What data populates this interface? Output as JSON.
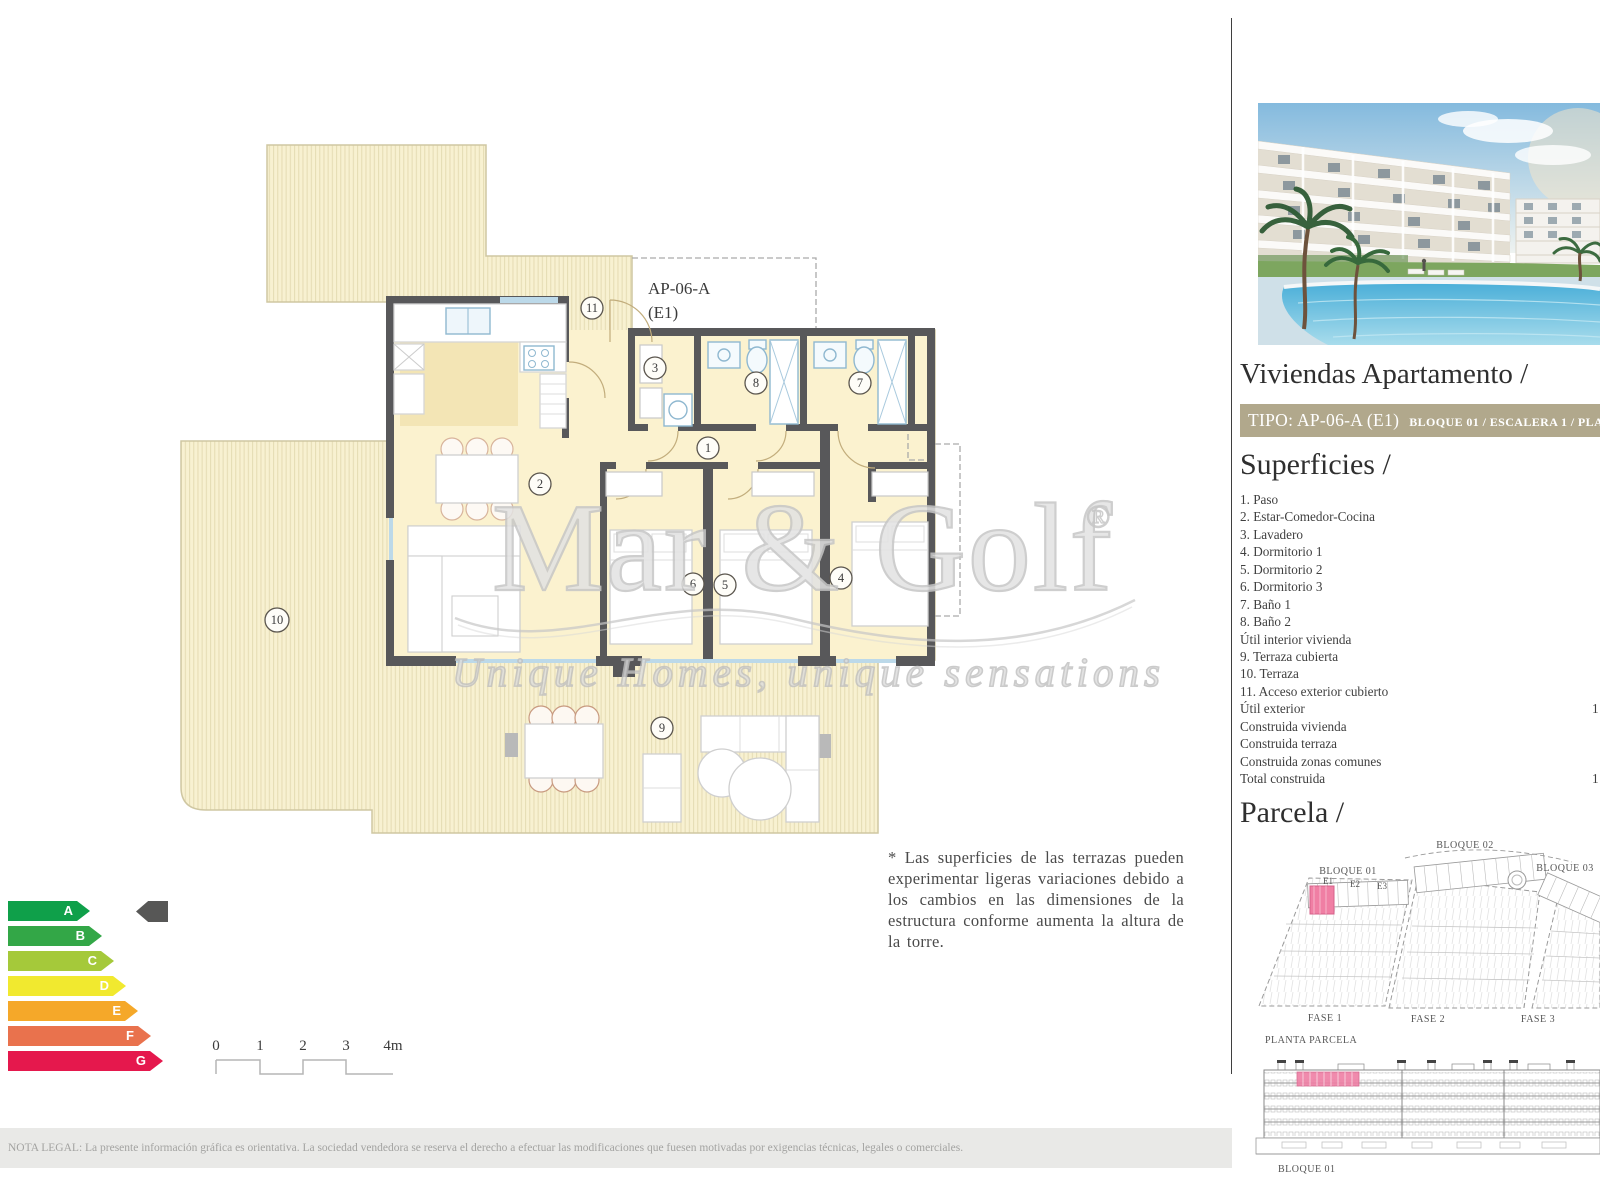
{
  "floorplan": {
    "unit_label": "AP-06-A",
    "unit_sublabel": "(E1)",
    "rooms": [
      {
        "num": "1"
      },
      {
        "num": "2"
      },
      {
        "num": "3"
      },
      {
        "num": "4"
      },
      {
        "num": "5"
      },
      {
        "num": "6"
      },
      {
        "num": "7"
      },
      {
        "num": "8"
      },
      {
        "num": "9"
      },
      {
        "num": "10"
      },
      {
        "num": "11"
      }
    ]
  },
  "watermark": {
    "brand": "Mar & Golf",
    "registered": "®",
    "tagline": "Unique Homes, unique sensations"
  },
  "scalebar": {
    "ticks": [
      "0",
      "1",
      "2",
      "3",
      "4m"
    ]
  },
  "energy": {
    "rows": [
      {
        "letter": "A",
        "color": "#0fa04a"
      },
      {
        "letter": "B",
        "color": "#33a747"
      },
      {
        "letter": "C",
        "color": "#a5c93a"
      },
      {
        "letter": "D",
        "color": "#f1e92f"
      },
      {
        "letter": "E",
        "color": "#f5a829"
      },
      {
        "letter": "F",
        "color": "#e9724d"
      },
      {
        "letter": "G",
        "color": "#e5184d"
      }
    ],
    "pointer_color": "#575756"
  },
  "note": "* Las superficies de las terrazas pueden experimentar ligeras variaciones debido a los cambios en las dimensiones de la estructura conforme aumenta la altura de la torre.",
  "legal": "NOTA LEGAL: La presente información gráfica es orientativa. La sociedad vendedora se reserva el derecho a efectuar las modificaciones que fuesen motivadas por exigencias técnicas, legales o comerciales.",
  "sidebar": {
    "title": "Viviendas Apartamento /",
    "tipo_bar": {
      "tipo": "TIPO: AP-06-A (E1)",
      "location": "BLOQUE 01  / ESCALERA 1 / PLANTA Á",
      "bg": "#b1a88c"
    },
    "superficies": {
      "heading": "Superficies /",
      "items": [
        {
          "label": "1. Paso",
          "value": ""
        },
        {
          "label": "2. Estar-Comedor-Cocina",
          "value": ""
        },
        {
          "label": "3. Lavadero",
          "value": ""
        },
        {
          "label": "4. Dormitorio 1",
          "value": ""
        },
        {
          "label": "5. Dormitorio 2",
          "value": ""
        },
        {
          "label": "6. Dormitorio 3",
          "value": ""
        },
        {
          "label": "7. Baño 1",
          "value": ""
        },
        {
          "label": "8. Baño 2",
          "value": ""
        },
        {
          "label": "Útil interior vivienda",
          "value": ""
        },
        {
          "label": "9. Terraza cubierta",
          "value": ""
        },
        {
          "label": "10. Terraza",
          "value": ""
        },
        {
          "label": "11. Acceso exterior cubierto",
          "value": ""
        },
        {
          "label": "Útil exterior",
          "value": "1"
        },
        {
          "label": "Construida vivienda",
          "value": ""
        },
        {
          "label": "Construida terraza",
          "value": ""
        },
        {
          "label": "Construida zonas comunes",
          "value": ""
        },
        {
          "label": "Total construida",
          "value": "1"
        }
      ]
    },
    "parcela": {
      "heading": "Parcela /",
      "bloque01": "BLOQUE 01",
      "bloque02": "BLOQUE 02",
      "bloque03": "BLOQUE 03",
      "e1": "E1",
      "e2": "E2",
      "e3": "E3",
      "fase1": "FASE 1",
      "fase2": "FASE 2",
      "fase3": "FASE 3",
      "planta": "PLANTA PARCELA",
      "highlight_color": "#f07fa4"
    },
    "elevation": {
      "label": "BLOQUE 01",
      "highlight_color": "#ef7fa5"
    }
  }
}
